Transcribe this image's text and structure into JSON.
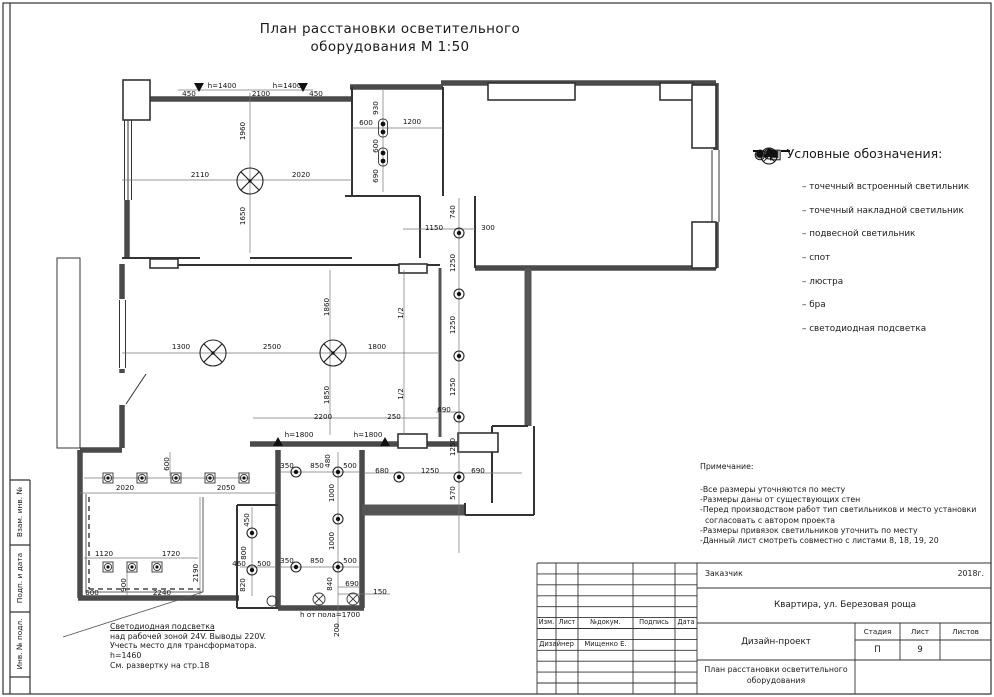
{
  "page": {
    "title_line1": "План расстановки осветительного",
    "title_line2": "оборудования М 1:50"
  },
  "legend": {
    "title": "Условные обозначения:",
    "items": [
      {
        "icon": "recessed-light-icon",
        "label": "– точечный встроенный светильник"
      },
      {
        "icon": "surface-light-icon",
        "label": "– точечный накладной светильник"
      },
      {
        "icon": "pendant-light-icon",
        "label": "– подвесной светильник"
      },
      {
        "icon": "spot-light-icon",
        "label": "– спот"
      },
      {
        "icon": "chandelier-icon",
        "label": "– люстра"
      },
      {
        "icon": "bra-icon",
        "label": "– бра"
      },
      {
        "icon": "led-strip-icon",
        "label": "– светодиодная подсветка"
      }
    ]
  },
  "notes": {
    "title": "Примечание:",
    "lines": [
      "-Все размеры уточняются по месту",
      "-Размеры даны от существующих стен",
      "-Перед производством работ тип светильников и место установки",
      "  согласовать с автором проекта",
      "-Размеры привязок светильников уточнить по месту",
      "-Данный лист смотреть совместно с листами 8, 18, 19, 20"
    ]
  },
  "led_note": {
    "lines": [
      "Светодиодная подсветка",
      "над рабочей зоной 24V. Выводы 220V.",
      "Учесть место для трансформатора.",
      "h=1460",
      "См. развертку на стр.18"
    ]
  },
  "frame": {
    "stamps": [
      "Взам. инв. №",
      "Подп. и дата",
      "Инв. № подл."
    ]
  },
  "title_block": {
    "customer_label": "Заказчик",
    "year": "2018г.",
    "object": "Квартира, ул. Березовая роща",
    "col_izm": "Изм.",
    "col_list": "Лист",
    "col_doc": "№докум.",
    "col_sign": "Подпись",
    "col_date": "Дата",
    "designer_role": "Дизайнер",
    "designer_name": "Мищенко Е.",
    "project": "Дизайн-проект",
    "stage_label": "Стадия",
    "sheet_label": "Лист",
    "sheets_label": "Листов",
    "stage_value": "П",
    "sheet_value": "9",
    "sheets_value": "",
    "drawing_title": "План расстановки осветительного оборудования"
  },
  "plan": {
    "dims": [
      {
        "t": "450",
        "x": 189,
        "y": 96
      },
      {
        "t": "h=1400",
        "x": 222,
        "y": 88
      },
      {
        "t": "2100",
        "x": 261,
        "y": 96
      },
      {
        "t": "h=1400",
        "x": 287,
        "y": 88
      },
      {
        "t": "450",
        "x": 316,
        "y": 96
      },
      {
        "t": "1960",
        "x": 245,
        "y": 131,
        "r": 1
      },
      {
        "t": "2110",
        "x": 200,
        "y": 177
      },
      {
        "t": "2020",
        "x": 301,
        "y": 177
      },
      {
        "t": "1650",
        "x": 245,
        "y": 216,
        "r": 1
      },
      {
        "t": "930",
        "x": 378,
        "y": 108,
        "r": 1
      },
      {
        "t": "600",
        "x": 366,
        "y": 125
      },
      {
        "t": "1200",
        "x": 412,
        "y": 124
      },
      {
        "t": "600",
        "x": 378,
        "y": 146,
        "r": 1
      },
      {
        "t": "690",
        "x": 378,
        "y": 176,
        "r": 1
      },
      {
        "t": "740",
        "x": 455,
        "y": 212,
        "r": 1
      },
      {
        "t": "1150",
        "x": 434,
        "y": 230
      },
      {
        "t": "300",
        "x": 488,
        "y": 230
      },
      {
        "t": "1250",
        "x": 455,
        "y": 263,
        "r": 1
      },
      {
        "t": "1250",
        "x": 455,
        "y": 325,
        "r": 1
      },
      {
        "t": "1250",
        "x": 455,
        "y": 387,
        "r": 1
      },
      {
        "t": "690",
        "x": 444,
        "y": 412
      },
      {
        "t": "1250",
        "x": 455,
        "y": 447,
        "r": 1
      },
      {
        "t": "680",
        "x": 382,
        "y": 473
      },
      {
        "t": "1250",
        "x": 430,
        "y": 473
      },
      {
        "t": "690",
        "x": 478,
        "y": 473
      },
      {
        "t": "570",
        "x": 455,
        "y": 493,
        "r": 1
      },
      {
        "t": "1300",
        "x": 181,
        "y": 349
      },
      {
        "t": "2500",
        "x": 272,
        "y": 349
      },
      {
        "t": "1800",
        "x": 377,
        "y": 349
      },
      {
        "t": "1860",
        "x": 329,
        "y": 307,
        "r": 1
      },
      {
        "t": "1850",
        "x": 329,
        "y": 395,
        "r": 1
      },
      {
        "t": "1/2",
        "x": 403,
        "y": 313,
        "r": 1
      },
      {
        "t": "1/2",
        "x": 403,
        "y": 394,
        "r": 1
      },
      {
        "t": "2200",
        "x": 323,
        "y": 419
      },
      {
        "t": "250",
        "x": 394,
        "y": 419
      },
      {
        "t": "h=1800",
        "x": 299,
        "y": 437
      },
      {
        "t": "h=1800",
        "x": 368,
        "y": 437
      },
      {
        "t": "600",
        "x": 169,
        "y": 464,
        "r": 1
      },
      {
        "t": "2020",
        "x": 125,
        "y": 490
      },
      {
        "t": "2050",
        "x": 226,
        "y": 490
      },
      {
        "t": "1120",
        "x": 104,
        "y": 556
      },
      {
        "t": "1720",
        "x": 171,
        "y": 556
      },
      {
        "t": "900",
        "x": 126,
        "y": 585,
        "r": 1
      },
      {
        "t": "2190",
        "x": 198,
        "y": 573,
        "r": 1
      },
      {
        "t": "600",
        "x": 92,
        "y": 595
      },
      {
        "t": "2240",
        "x": 162,
        "y": 595
      },
      {
        "t": "450",
        "x": 249,
        "y": 520,
        "r": 1
      },
      {
        "t": "800",
        "x": 246,
        "y": 553,
        "r": 1
      },
      {
        "t": "460",
        "x": 239,
        "y": 566
      },
      {
        "t": "500",
        "x": 264,
        "y": 566
      },
      {
        "t": "820",
        "x": 245,
        "y": 585,
        "r": 1
      },
      {
        "t": "350",
        "x": 287,
        "y": 468
      },
      {
        "t": "850",
        "x": 317,
        "y": 468
      },
      {
        "t": "480",
        "x": 330,
        "y": 461,
        "r": 1
      },
      {
        "t": "500",
        "x": 350,
        "y": 468
      },
      {
        "t": "1000",
        "x": 334,
        "y": 493,
        "r": 1
      },
      {
        "t": "1000",
        "x": 334,
        "y": 541,
        "r": 1
      },
      {
        "t": "350",
        "x": 287,
        "y": 563
      },
      {
        "t": "850",
        "x": 317,
        "y": 563
      },
      {
        "t": "500",
        "x": 350,
        "y": 563
      },
      {
        "t": "840",
        "x": 332,
        "y": 584,
        "r": 1
      },
      {
        "t": "690",
        "x": 352,
        "y": 586
      },
      {
        "t": "150",
        "x": 380,
        "y": 594
      },
      {
        "t": "h от пола=1700",
        "x": 330,
        "y": 617
      },
      {
        "t": "200",
        "x": 339,
        "y": 630,
        "r": 1
      }
    ],
    "fixtures": [
      {
        "type": "chandelier",
        "x": 250,
        "y": 181
      },
      {
        "type": "chandelier",
        "x": 213,
        "y": 353
      },
      {
        "type": "chandelier",
        "x": 333,
        "y": 353
      },
      {
        "type": "pendant",
        "x": 319,
        "y": 599
      },
      {
        "type": "pendant",
        "x": 353,
        "y": 599
      },
      {
        "type": "surface",
        "x": 459,
        "y": 233
      },
      {
        "type": "surface",
        "x": 459,
        "y": 294
      },
      {
        "type": "surface",
        "x": 459,
        "y": 356
      },
      {
        "type": "surface",
        "x": 459,
        "y": 417
      },
      {
        "type": "surface",
        "x": 459,
        "y": 477
      },
      {
        "type": "surface",
        "x": 399,
        "y": 477
      },
      {
        "type": "surface",
        "x": 296,
        "y": 472
      },
      {
        "type": "surface",
        "x": 338,
        "y": 472
      },
      {
        "type": "surface",
        "x": 338,
        "y": 519
      },
      {
        "type": "surface",
        "x": 296,
        "y": 567
      },
      {
        "type": "surface",
        "x": 338,
        "y": 567
      },
      {
        "type": "surface",
        "x": 252,
        "y": 533
      },
      {
        "type": "surface",
        "x": 252,
        "y": 570
      },
      {
        "type": "spot",
        "x": 108,
        "y": 478
      },
      {
        "type": "spot",
        "x": 142,
        "y": 478
      },
      {
        "type": "spot",
        "x": 176,
        "y": 478
      },
      {
        "type": "spot",
        "x": 210,
        "y": 478
      },
      {
        "type": "spot",
        "x": 244,
        "y": 478
      },
      {
        "type": "spot",
        "x": 108,
        "y": 567
      },
      {
        "type": "spot",
        "x": 132,
        "y": 567
      },
      {
        "type": "spot",
        "x": 157,
        "y": 567
      },
      {
        "type": "recessed-pair",
        "x": 383,
        "y": 128
      },
      {
        "type": "recessed-pair",
        "x": 383,
        "y": 157
      },
      {
        "type": "bra-down",
        "x": 199,
        "y": 91
      },
      {
        "type": "bra-down",
        "x": 303,
        "y": 91
      },
      {
        "type": "bra-up",
        "x": 278,
        "y": 438
      },
      {
        "type": "bra-up",
        "x": 385,
        "y": 438
      }
    ]
  }
}
